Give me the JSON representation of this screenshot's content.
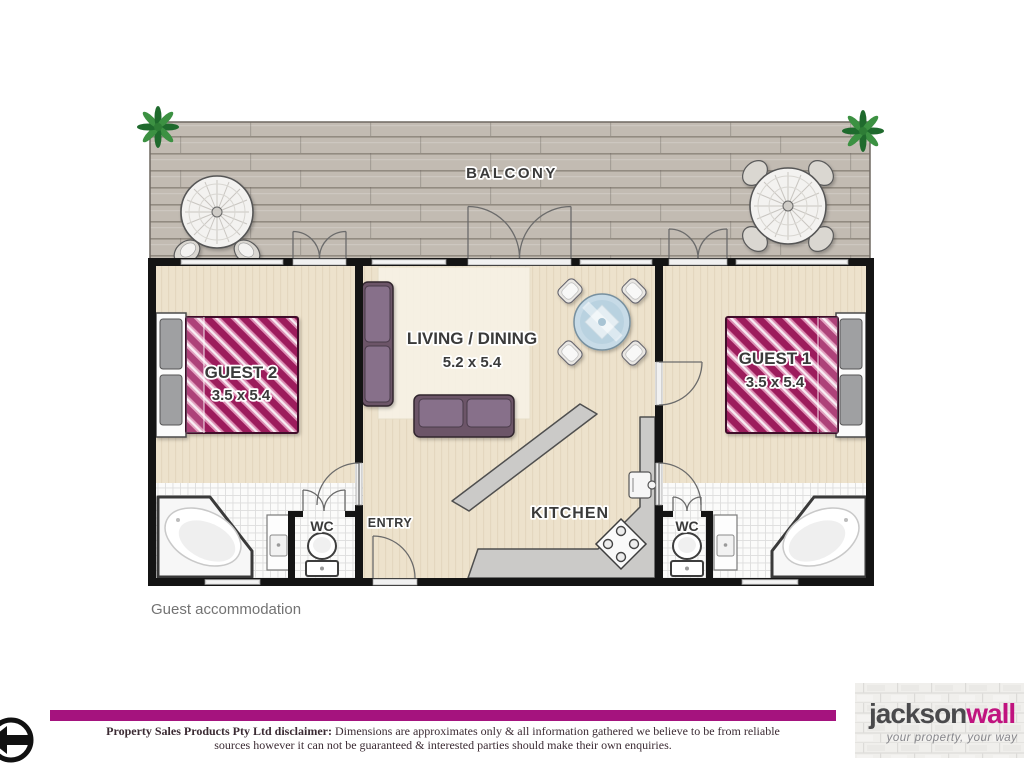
{
  "page": {
    "caption": "Guest accommodation"
  },
  "floorplan": {
    "balcony": {
      "label": "BALCONY"
    },
    "rooms": {
      "guest2": {
        "label": "GUEST 2",
        "dims": "3.5 x 5.4"
      },
      "living": {
        "label": "LIVING / DINING",
        "dims": "5.2 x 5.4"
      },
      "guest1": {
        "label": "GUEST 1",
        "dims": "3.5 x 5.4"
      },
      "kitchen": {
        "label": "KITCHEN"
      },
      "entry": {
        "label": "ENTRY"
      },
      "wc_left": {
        "label": "WC"
      },
      "wc_right": {
        "label": "WC"
      }
    },
    "colors": {
      "bed_cover": "#9C1A5C",
      "bed_stripe": "#F9ECF3",
      "floor": "#EDE2CC",
      "deck": "#C2BBB2",
      "tile": "#FBFBFA",
      "sofa": "#6C5468",
      "wall": "#141414"
    }
  },
  "footer": {
    "disclaimer": {
      "bold": "Property Sales Products Pty Ltd disclaimer:",
      "line1_rest": " Dimensions are approximates only & all information gathered we believe to be from reliable",
      "line2": "sources however it can not be guaranteed & interested parties should make their own enquiries."
    },
    "logo": {
      "name_part1": "jackson",
      "name_part2": "wall",
      "tagline": "your property, your way"
    },
    "colors": {
      "bar": "#A5137E",
      "logo_accent": "#C0137F",
      "logo_gray": "#4A4A4C"
    },
    "icons": {
      "compass": "left-arrow-circle-icon"
    }
  }
}
